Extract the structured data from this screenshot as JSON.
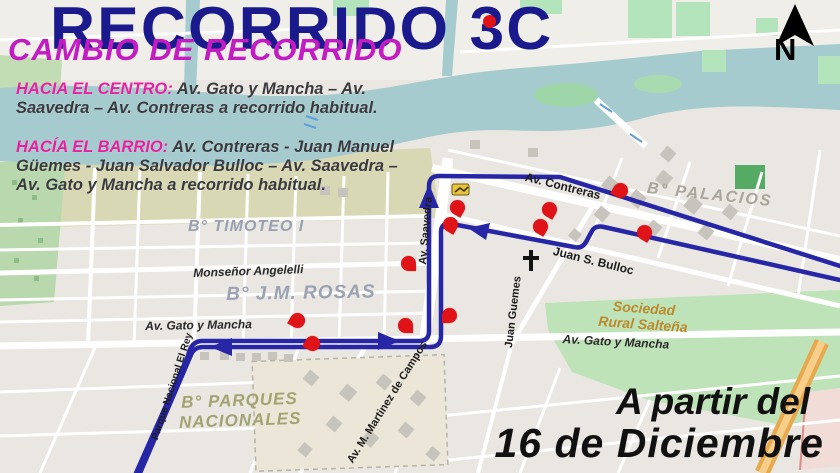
{
  "header": {
    "title": "RECORRIDO 3C",
    "subtitle": "CAMBIO DE RECORRIDO",
    "routes": [
      {
        "label": "HACIA EL CENTRO:",
        "text": "Av. Gato y Mancha – Av. Saavedra – Av. Contreras a recorrido habitual."
      },
      {
        "label": "HACÍA EL BARRIO:",
        "text": "Av. Contreras  - Juan Manuel Güemes  - Juan Salvador Bulloc – Av. Saavedra – Av. Gato y Mancha a recorrido habitual."
      }
    ]
  },
  "effective_date": {
    "line1": "A partir del",
    "line2": "16 de Diciembre"
  },
  "compass": {
    "letter": "N"
  },
  "map": {
    "colors": {
      "route_blue": "#2626a6",
      "marker_red": "#e01418",
      "water": "#a6cbcf",
      "green": "#bfe3b8",
      "title_navy": "#1a1a8c",
      "subtitle_magenta": "#c21cc2",
      "highlight_pink": "#e8209e"
    },
    "labels": [
      {
        "id": "b-timoteo",
        "text": "B° TIMOTEO I",
        "x": 188,
        "y": 218,
        "rot": 0,
        "cls": "lbl-barrio"
      },
      {
        "id": "monsenor-angelelli",
        "text": "Monseñor Angelelli",
        "x": 193,
        "y": 266,
        "rot": -2,
        "cls": "lbl-street-it"
      },
      {
        "id": "b-jm-rosas",
        "text": "B° J.M. ROSAS",
        "x": 226,
        "y": 284,
        "rot": -1,
        "cls": "lbl-barrio2"
      },
      {
        "id": "b-palacios",
        "text": "B° PALACIOS",
        "x": 648,
        "y": 180,
        "rot": 6,
        "cls": "lbl-gray"
      },
      {
        "id": "av-contreras",
        "text": "Av. Contreras",
        "x": 527,
        "y": 170,
        "rot": 14,
        "cls": "lbl-street"
      },
      {
        "id": "juan-s-bulloc",
        "text": "Juan S. Bulloc",
        "x": 555,
        "y": 244,
        "rot": 14,
        "cls": "lbl-street"
      },
      {
        "id": "av-saavedra",
        "text": "Av. Saavedra",
        "x": 417,
        "y": 264,
        "rot": -85,
        "cls": "lbl-street",
        "size": 11
      },
      {
        "id": "juan-guemes",
        "text": "Juan Guemes",
        "x": 503,
        "y": 347,
        "rot": -83,
        "cls": "lbl-street",
        "size": 11
      },
      {
        "id": "gato-mancha-left",
        "text": "Av. Gato y Mancha",
        "x": 145,
        "y": 319,
        "rot": -1,
        "cls": "lbl-street-it"
      },
      {
        "id": "gato-mancha-right",
        "text": "Av. Gato y Mancha",
        "x": 563,
        "y": 332,
        "rot": 3,
        "cls": "lbl-street-it"
      },
      {
        "id": "sociedad-rural",
        "text": "Sociedad\nRural Salteña",
        "x": 600,
        "y": 297,
        "rot": 4,
        "cls": "lbl-orange"
      },
      {
        "id": "b-parques",
        "text": "B° PARQUES\nNACIONALES",
        "x": 178,
        "y": 393,
        "rot": -2,
        "cls": "lbl-olive"
      },
      {
        "id": "av-martinez",
        "text": "Av. M. Martinez  de Campos",
        "x": 345,
        "y": 459,
        "rot": -58,
        "cls": "lbl-street",
        "size": 11
      },
      {
        "id": "parque-el-rey",
        "text": "Parque Nacional El Rey",
        "x": 150,
        "y": 438,
        "rot": -72,
        "cls": "lbl-street",
        "size": 10
      }
    ],
    "markers": [
      {
        "x": 457,
        "y": 207,
        "rot": -105
      },
      {
        "x": 450,
        "y": 224,
        "rot": -105
      },
      {
        "x": 549,
        "y": 209,
        "rot": -105
      },
      {
        "x": 540,
        "y": 226,
        "rot": -105
      },
      {
        "x": 620,
        "y": 190,
        "rot": -15
      },
      {
        "x": 644,
        "y": 232,
        "rot": -105
      },
      {
        "x": 408,
        "y": 263,
        "rot": -135
      },
      {
        "x": 449,
        "y": 315,
        "rot": -45
      },
      {
        "x": 405,
        "y": 325,
        "rot": -135
      },
      {
        "x": 297,
        "y": 320,
        "rot": -15
      },
      {
        "x": 312,
        "y": 343,
        "rot": -15
      }
    ]
  }
}
